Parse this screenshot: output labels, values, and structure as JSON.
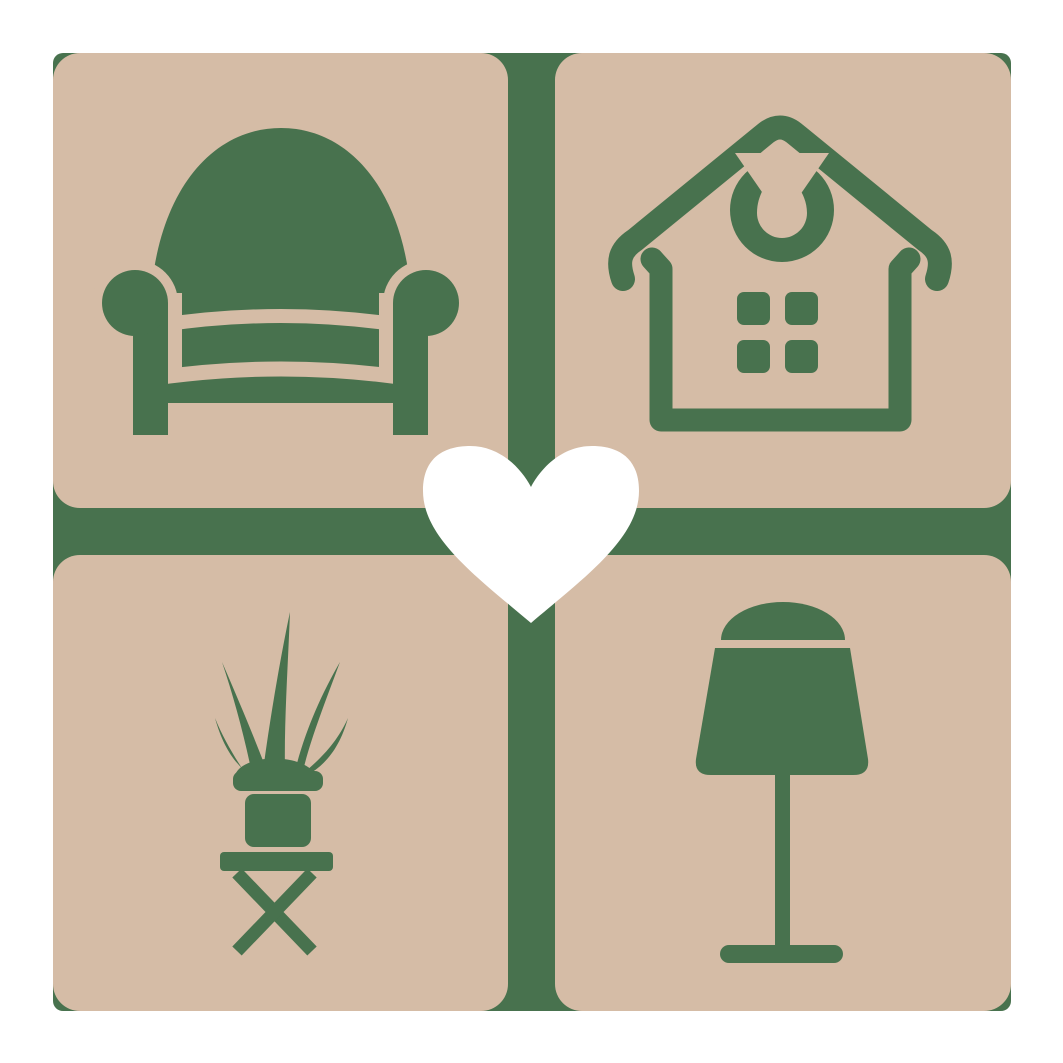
{
  "canvas": {
    "width": 1063,
    "height": 1063
  },
  "colors": {
    "background": "#ffffff",
    "backdrop_green": "#48724e",
    "tile_tan": "#d5bca6",
    "icon_green": "#48724e",
    "heart_white": "#ffffff"
  },
  "logo": {
    "kind": "furniture-home-decor-logo",
    "tiles": [
      {
        "position": "top-left",
        "icon": "armchair-icon",
        "subject": "armchair"
      },
      {
        "position": "top-right",
        "icon": "house-icon",
        "subject": "house with window and droplet emblem"
      },
      {
        "position": "bottom-left",
        "icon": "potted-plant-icon",
        "subject": "potted plant on folding stool"
      },
      {
        "position": "bottom-right",
        "icon": "table-lamp-icon",
        "subject": "table lamp"
      }
    ],
    "center_motif": {
      "icon": "heart-icon",
      "subject": "heart"
    }
  }
}
